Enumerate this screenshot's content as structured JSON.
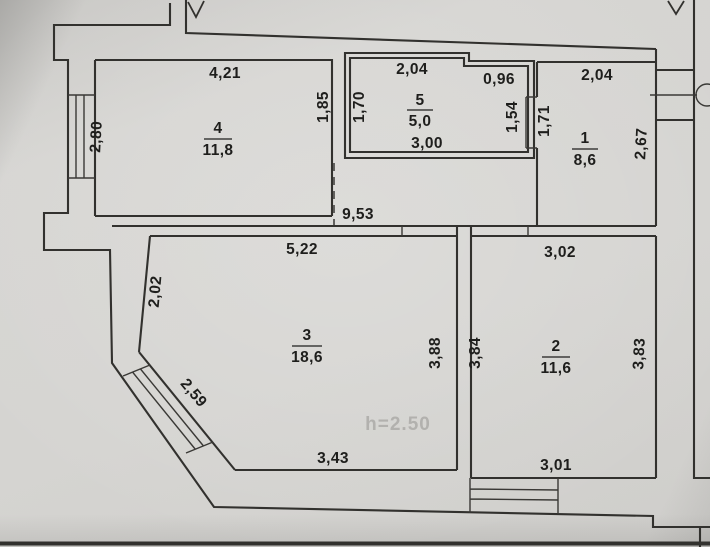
{
  "plan": {
    "rooms": {
      "room1": {
        "number": "1",
        "area": "8,6",
        "dim_top": "2,04",
        "dim_left": "1,71",
        "dim_right": "2,67"
      },
      "room2": {
        "number": "2",
        "area": "11,6",
        "dim_top": "3,02",
        "dim_left": "3,84",
        "dim_right": "3,83",
        "dim_bottom": "3,01"
      },
      "room3": {
        "number": "3",
        "area": "18,6",
        "dim_top": "5,22",
        "dim_left": "2,02",
        "dim_diagonal": "2,59",
        "dim_right": "3,88",
        "dim_bottom": "3,43"
      },
      "room4": {
        "number": "4",
        "area": "11,8",
        "dim_top": "4,21",
        "dim_left": "2,80",
        "dim_right": "1,85"
      },
      "room5": {
        "number": "5",
        "area": "5,0",
        "dim_top_left": "2,04",
        "dim_top_right": "0,96",
        "dim_left": "1,70",
        "dim_right": "1,54",
        "dim_bottom": "3,00"
      }
    },
    "corridor": {
      "dim_length": "9,53"
    },
    "watermark": "h=2.50",
    "colors": {
      "paper": "#d5d4d1",
      "line": "#32312e",
      "dimension_text": "#1e1e1c",
      "watermark_text": "#b2b1ae"
    }
  }
}
